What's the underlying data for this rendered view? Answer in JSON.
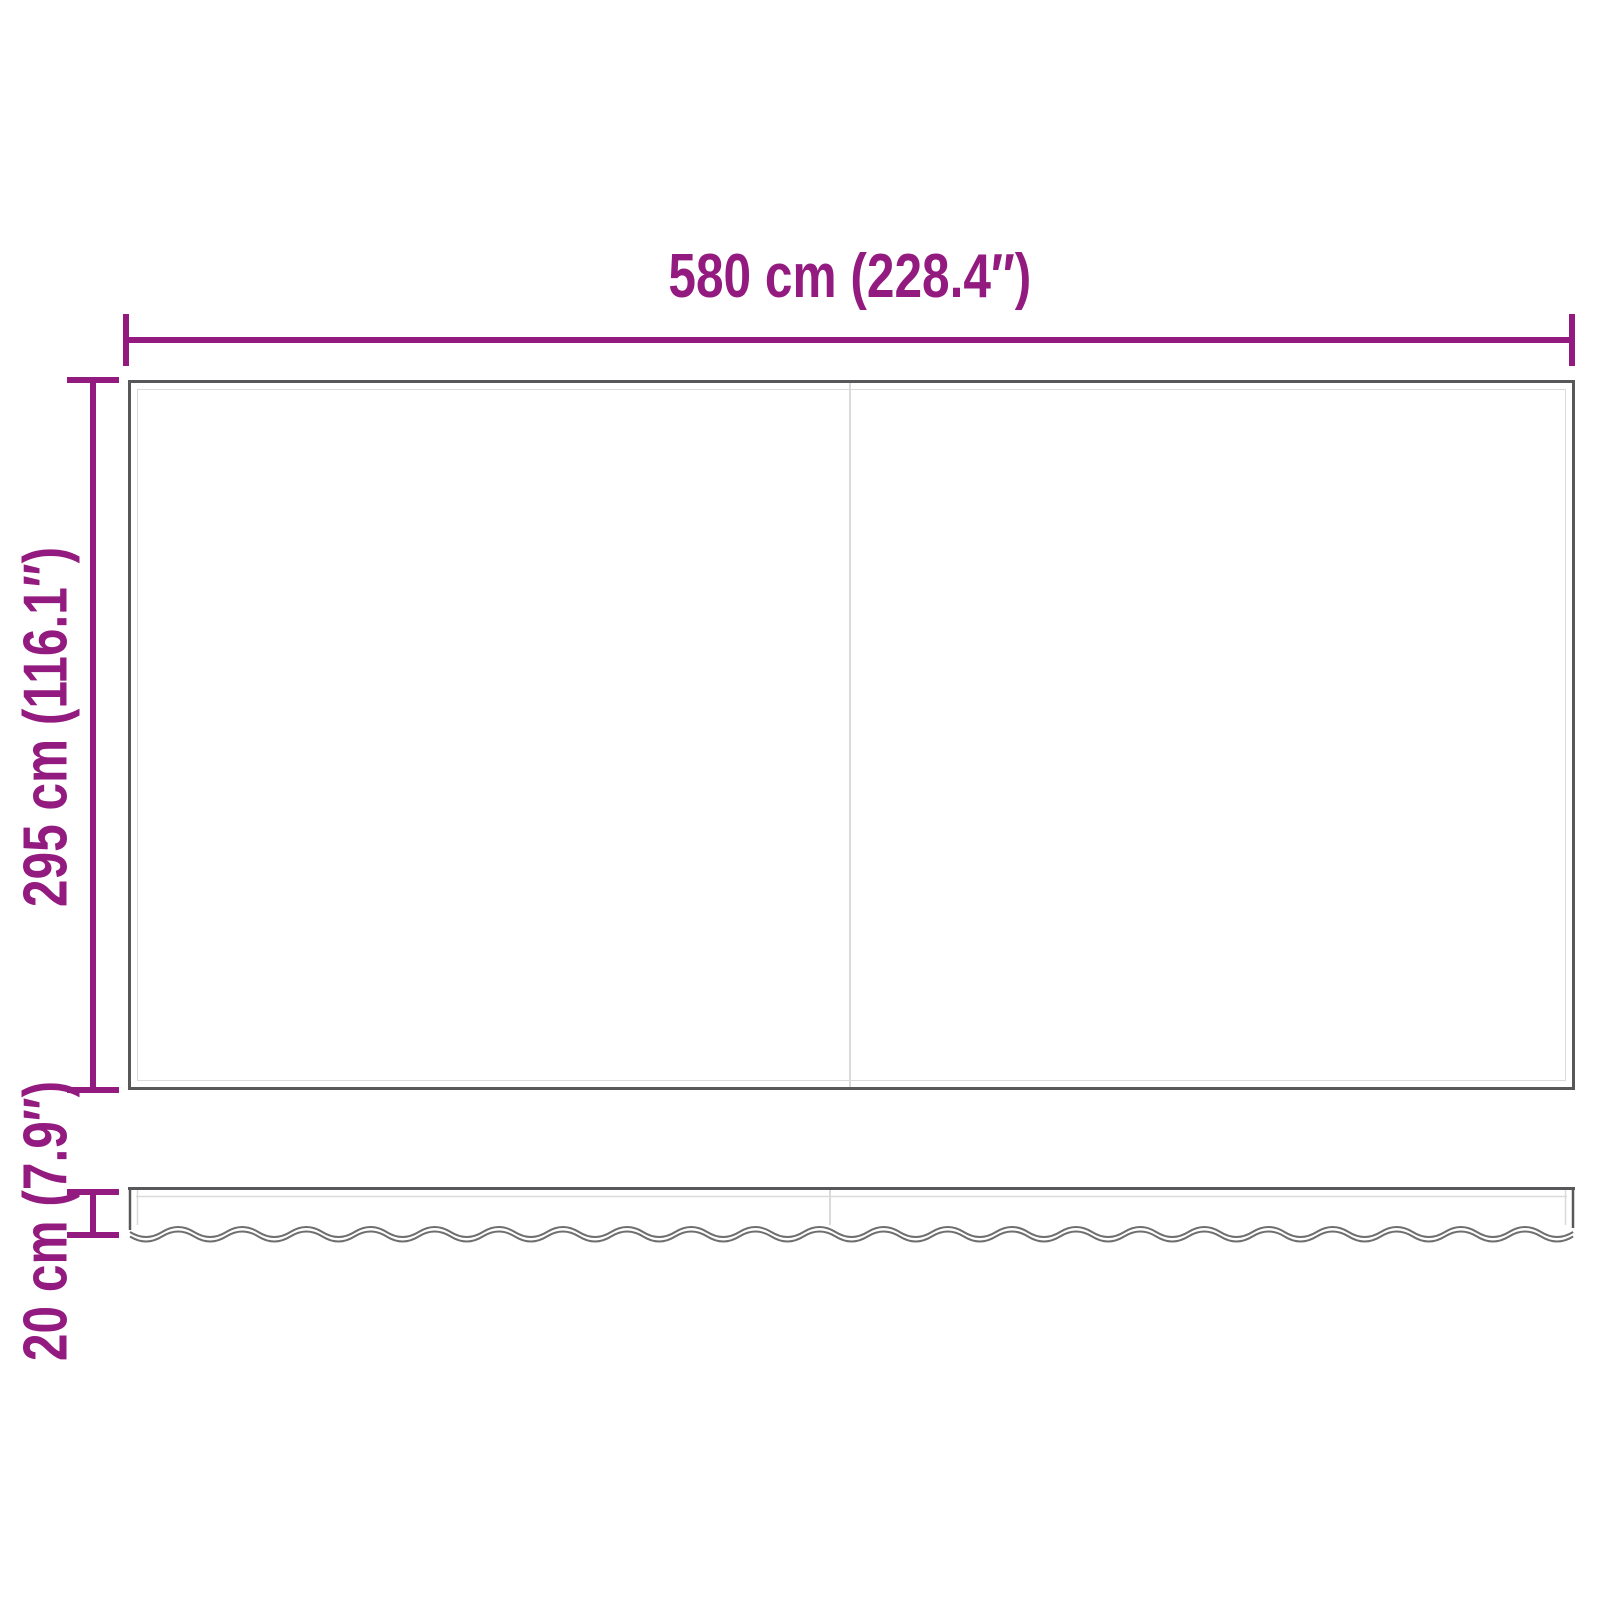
{
  "colors": {
    "dimension": "#931B80",
    "outline": "#58585A",
    "outline-soft": "#6E6E6E",
    "inner-line": "#DADADA",
    "background": "#FFFFFF"
  },
  "dimensions": {
    "width": {
      "label": "580 cm (228.4″)"
    },
    "height": {
      "label": "295 cm (116.1″)"
    },
    "valance-height": {
      "label": "20 cm (7.9″)"
    }
  }
}
